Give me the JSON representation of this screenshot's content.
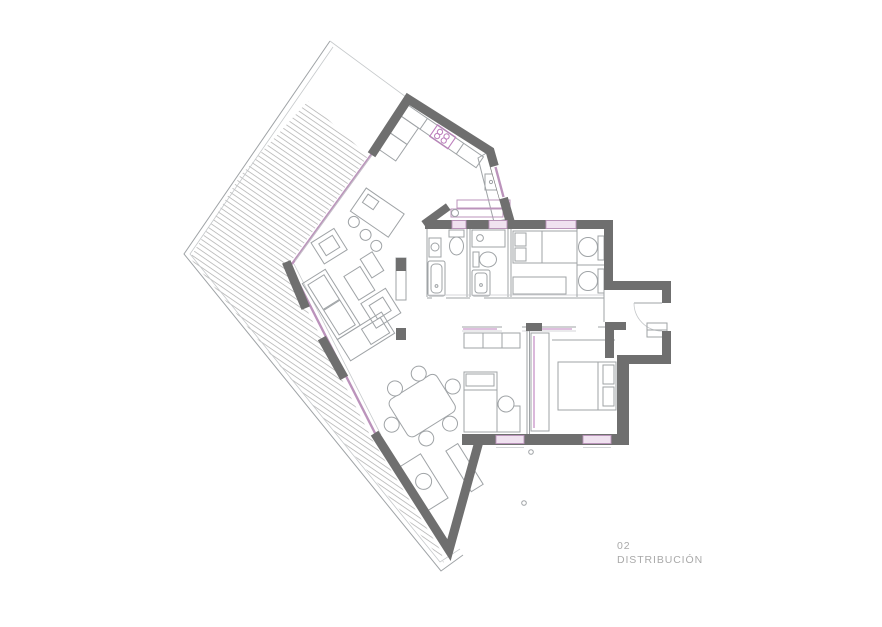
{
  "label": {
    "number": "02",
    "title": "DISTRIBUCIÓN"
  },
  "colors": {
    "wall": "#6f6f6f",
    "line": "#9fa3a6",
    "faint": "#c6c9cb",
    "glass_stroke": "#bb93bb",
    "glass_fill": "#f0e2f0",
    "accent_pink": "#bd7fbd",
    "hatch": "#b6b6b6",
    "label_text": "#a9a9a9",
    "background": "#ffffff"
  }
}
